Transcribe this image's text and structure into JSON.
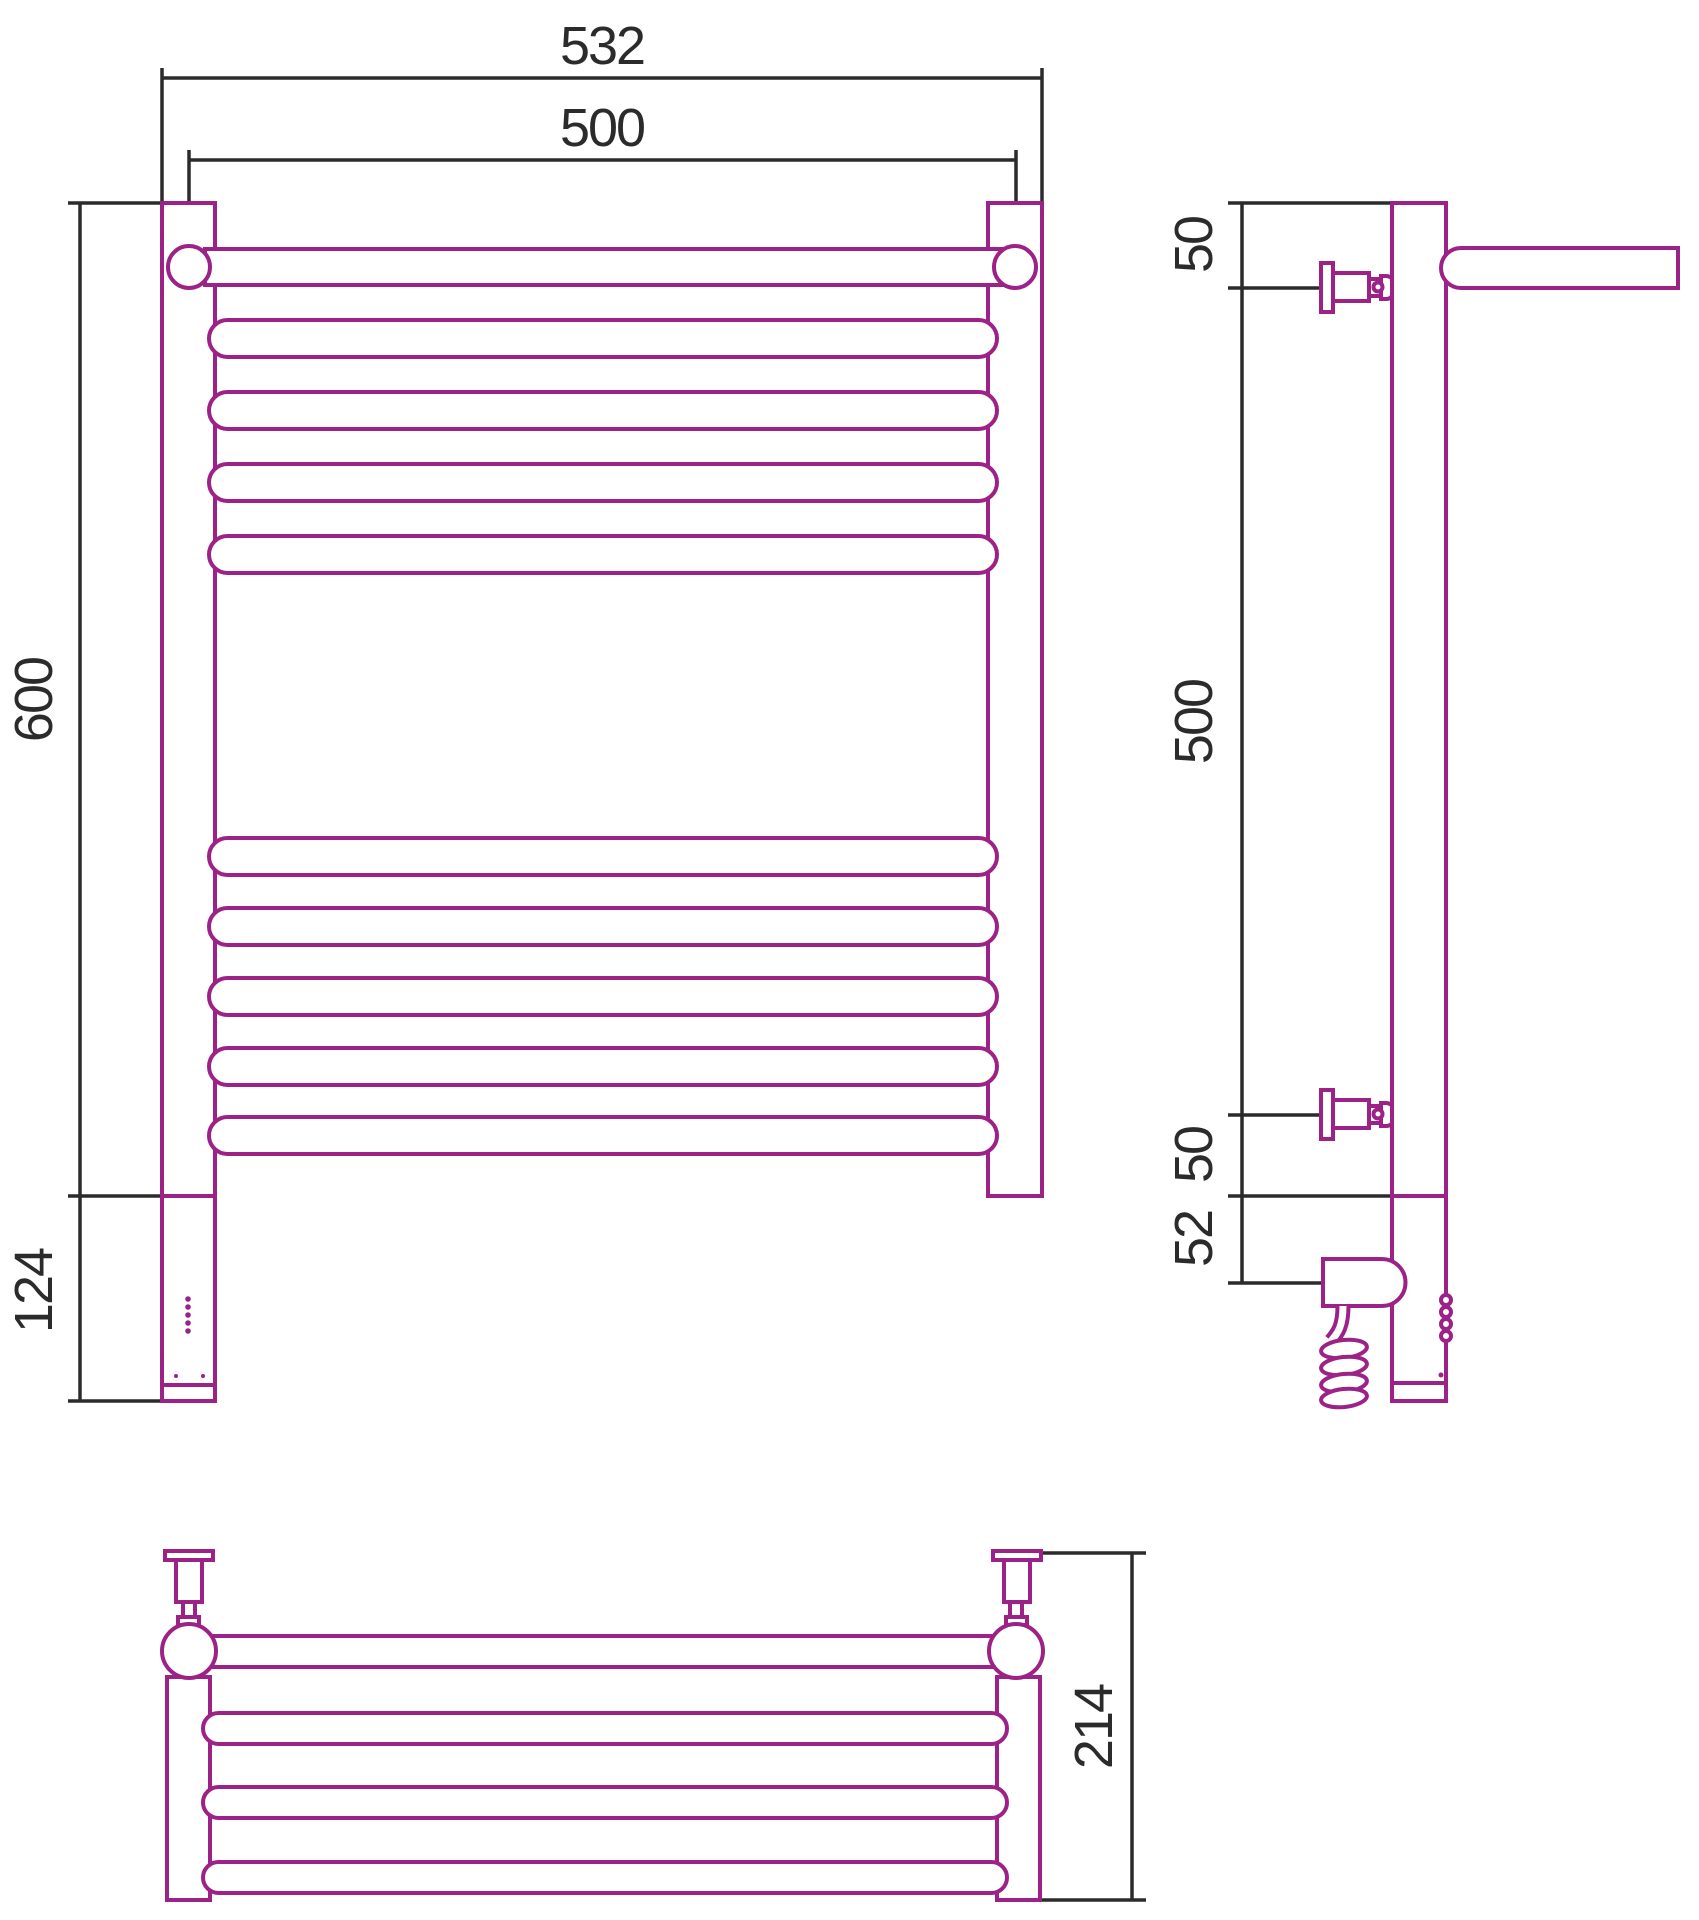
{
  "drawing": {
    "dimensions": {
      "front": {
        "overall_width": "532",
        "axis_width": "500",
        "height": "600",
        "lower_section_height": "124"
      },
      "side": {
        "top_bracket_offset": "50",
        "bracket_spacing": "500",
        "bottom_bracket_offset": "50",
        "heater_axis_offset": "52"
      },
      "top": {
        "depth": "214"
      }
    },
    "colors": {
      "outline": "#9C2287",
      "dimension_lines": "#2B2B2B",
      "background": "#FFFFFF"
    }
  }
}
